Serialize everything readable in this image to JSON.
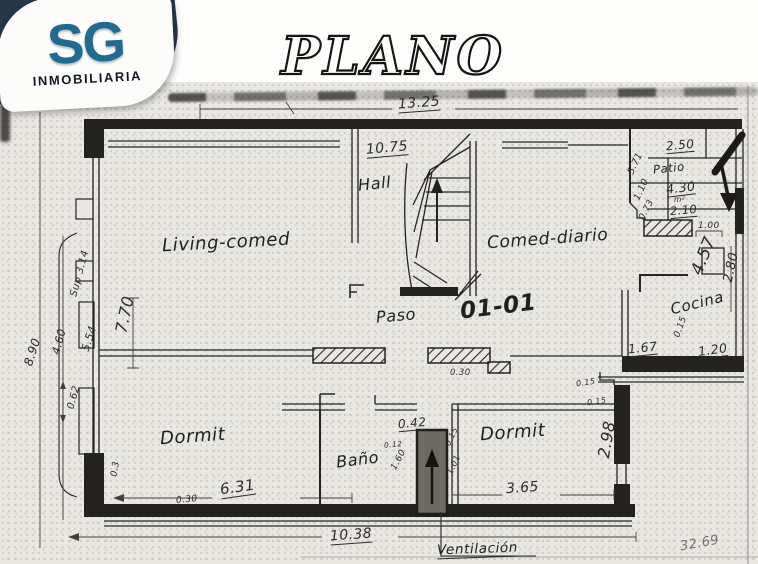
{
  "brand": {
    "initials": "SG",
    "name": "INMOBILIARIA"
  },
  "title": "PLANO",
  "plan": {
    "unit": "01-01",
    "rooms": {
      "living": "Living-comed",
      "hall": "Hall",
      "comedor": "Comed-diario",
      "paso": "Paso",
      "cocina": "Cocina",
      "patio": "Patio",
      "dormitorio_izquierdo": "Dormit",
      "bano": "Baño",
      "dormitorio_derecho": "Dormit"
    },
    "notes": {
      "ventilacion": "Ventilación",
      "superficie": "Sup 3.14",
      "patio_area_unidad": "m²"
    },
    "dims": {
      "frente_superior": "13.25",
      "interior_superior": "10.75",
      "patio_ancho": "2.50",
      "patio_area": "4.30",
      "patio_fondo": "2.10",
      "lateral_571": "5.71",
      "lateral_110": "1.10",
      "lateral_073": "0.73",
      "patio_100": "1.00",
      "diagonal_457": "4.57",
      "lateral_280": "2.80",
      "cocina_015": "0.15",
      "cocina_ancho": "1.67",
      "cocina_fondo": "1.20",
      "muro_015_a": "0.15",
      "muro_015_b": "0.15",
      "lateral_izquierdo": "8.90",
      "lateral_460": "4.60",
      "lateral_554": "5.54",
      "lateral_062": "0.62",
      "living_fondo": "7.70",
      "dorm_izq_ancho": "6.31",
      "muro_030_a": "0.30",
      "muro_030_b": "0.30",
      "muro_03": "0.3",
      "frente_inferior": "10.38",
      "dorm_der_ancho": "3.65",
      "dorm_der_fondo": "2.98",
      "conducto_ancho": "0.42",
      "conducto_012": "0.12",
      "conducto_160": "1.60",
      "conducto_101": "1.01",
      "conducto_015": "0.15",
      "total": "32.69"
    }
  }
}
